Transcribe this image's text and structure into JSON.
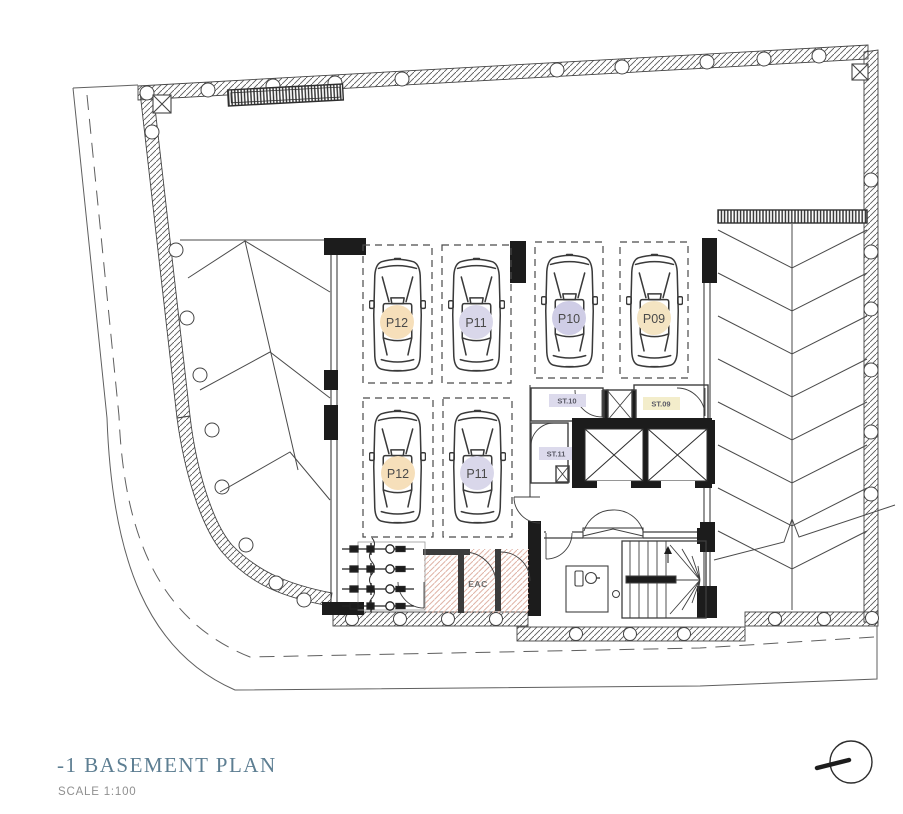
{
  "drawing": {
    "title": "-1 BASEMENT PLAN",
    "scale": "SCALE  1:100"
  },
  "stalls": [
    {
      "id": "P12",
      "badge_color": "#f6dfba"
    },
    {
      "id": "P11",
      "badge_color": "#d9d7ea"
    },
    {
      "id": "P10",
      "badge_color": "#cfcde6"
    },
    {
      "id": "P09",
      "badge_color": "#f4e4c2"
    },
    {
      "id": "P12",
      "badge_color": "#f6dfba"
    },
    {
      "id": "P11",
      "badge_color": "#d9d7ea"
    }
  ],
  "rooms": [
    {
      "id": "ST.10",
      "badge_color": "#dcdaec"
    },
    {
      "id": "ST.09",
      "badge_color": "#f3edcb"
    },
    {
      "id": "ST.11",
      "badge_color": "#dcdaec"
    },
    {
      "id": "EAC"
    }
  ],
  "colors": {
    "line": "#3f3f3f",
    "poche": "#1c1c1c",
    "title_accent": "#5d7e92",
    "eac_hatch": "#dfb3a6"
  }
}
